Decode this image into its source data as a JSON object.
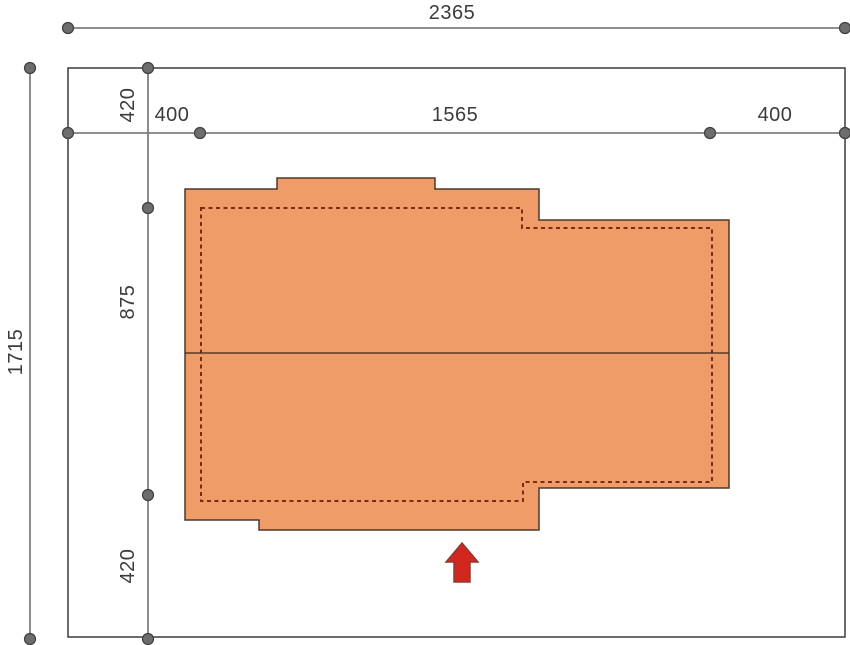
{
  "drawing": {
    "type": "architectural-site-plan",
    "colors": {
      "background": "#ffffff",
      "roof_fill": "#EF9C68",
      "roof_outline": "#4a3928",
      "wall_dashed": "#7d2b13",
      "ridge_line": "#3a2a1a",
      "plot_border": "#3c3c3c",
      "dimension_line": "#7f7f7f",
      "dimension_dot_fill": "#6d6d6d",
      "dimension_dot_stroke": "#3f3f3f",
      "label_text": "#3b3b3b",
      "arrow_fill": "#d2271e",
      "arrow_stroke": "#8c3b35"
    },
    "labels": {
      "plot_width": "2365",
      "plot_height": "1715",
      "setback_left": "400",
      "house_width": "1565",
      "setback_right": "400",
      "setback_top": "420",
      "house_depth": "875",
      "setback_bottom": "420"
    },
    "icons": {
      "entrance_arrow": "up-arrow"
    }
  }
}
